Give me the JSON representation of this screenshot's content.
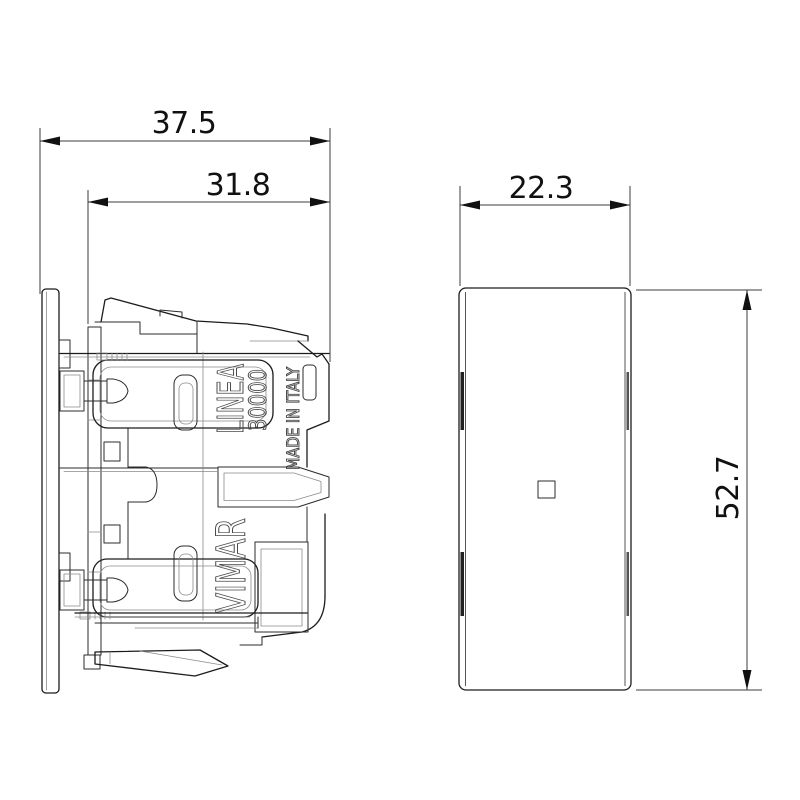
{
  "page": {
    "type": "technical-dimension-drawing",
    "background": "#ffffff"
  },
  "side_view": {
    "engravings": {
      "product_line": "LINEA",
      "series": "30000",
      "origin": "MADE IN ITALY",
      "brand": "VIMAR"
    }
  },
  "front_view": {
    "center_marker": "square"
  },
  "dimensions": {
    "overall_depth": {
      "value": "37.5"
    },
    "body_depth": {
      "value": "31.8"
    },
    "module_width": {
      "value": "22.3"
    },
    "module_height": {
      "value": "52.7"
    }
  },
  "colors": {
    "outline": "#1c1c1c",
    "dimension_line": "#3c3c3c",
    "dimension_text": "#111111",
    "engraving": "#4a4a4a",
    "background": "#ffffff"
  }
}
